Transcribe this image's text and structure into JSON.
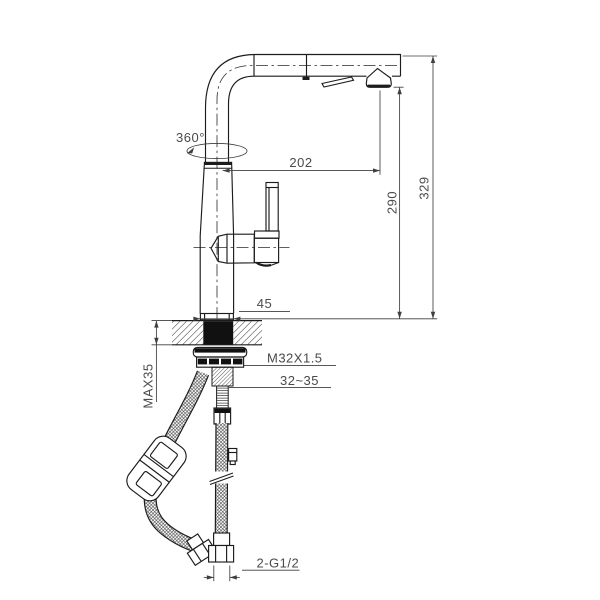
{
  "drawing": {
    "type": "technical-drawing",
    "subject": "pull-out kitchen faucet installation diagram with dimensions, mounting hardware and supply hoses",
    "labels": {
      "rotation": "360°",
      "spout_reach": "202",
      "spout_height": "290",
      "total_height": "329",
      "base_width": "45",
      "shank_thread": "M32X1.5",
      "hole_diameter": "32~35",
      "max_counter_thickness": "MAX35",
      "hose_thread": "2-G1/2"
    },
    "colors": {
      "line": "#1c1c1c",
      "dimension_line": "#3f3f3f",
      "dimension_text": "#4a4a4a",
      "background": "#ffffff"
    }
  }
}
